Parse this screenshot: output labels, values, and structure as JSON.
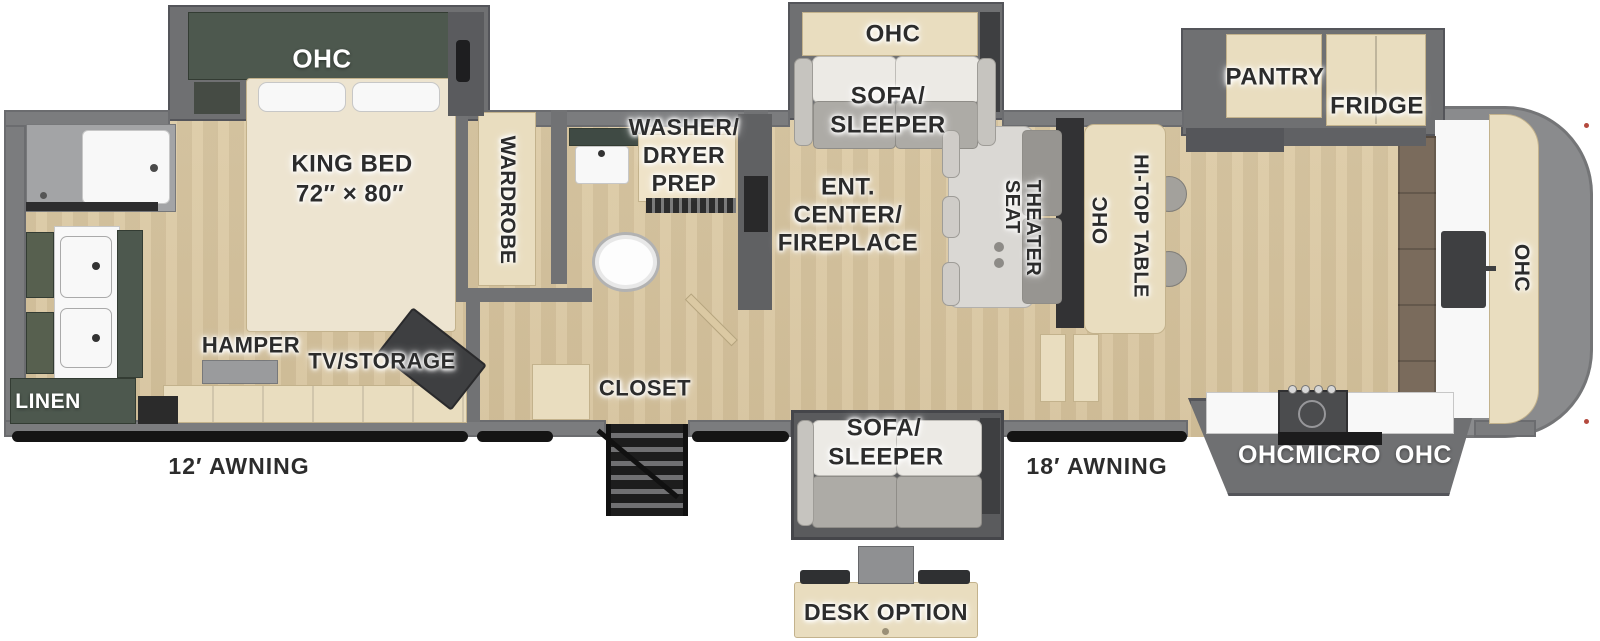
{
  "colors": {
    "wall_gray": "#7b7c7e",
    "slide_gray": "#6f7072",
    "floor_wood": "#d8c6a1",
    "cabinet_cream": "#e9ddbf",
    "cabinet_green": "#4d584e",
    "counter_white": "#f8f8f8",
    "fixture_dark": "#3e3f41",
    "label_dark": "#2c2c2c",
    "label_white": "#ffffff",
    "awning_black": "#141414"
  },
  "bedroom": {
    "ohc": "OHC",
    "king_bed_line1": "KING BED",
    "king_bed_line2": "72″ × 80″",
    "wardrobe": "WARDROBE",
    "hamper": "HAMPER",
    "tv_storage": "TV/STORAGE"
  },
  "bathroom": {
    "linen": "LINEN",
    "washer_dryer_line1": "WASHER/",
    "washer_dryer_line2": "DRYER",
    "washer_dryer_line3": "PREP",
    "closet": "CLOSET"
  },
  "living": {
    "sofa_ohc": "OHC",
    "sofa_line1": "SOFA/",
    "sofa_line2": "SLEEPER",
    "ent_line1": "ENT.",
    "ent_line2": "CENTER/",
    "ent_line3": "FIREPLACE",
    "theater_line1": "THEATER",
    "theater_line2": "SEAT",
    "hitop_ohc": "OHC",
    "hitop_table": "HI-TOP TABLE"
  },
  "kitchen": {
    "pantry": "PANTRY",
    "fridge": "FRIDGE",
    "ohc_left": "OHC",
    "micro": "MICRO",
    "ohc_right": "OHC",
    "rear_ohc": "OHC"
  },
  "lower": {
    "sofa_line1": "SOFA/",
    "sofa_line2": "SLEEPER",
    "desk_option": "DESK OPTION"
  },
  "exterior": {
    "awning_left": "12′ AWNING",
    "awning_right": "18′ AWNING"
  }
}
